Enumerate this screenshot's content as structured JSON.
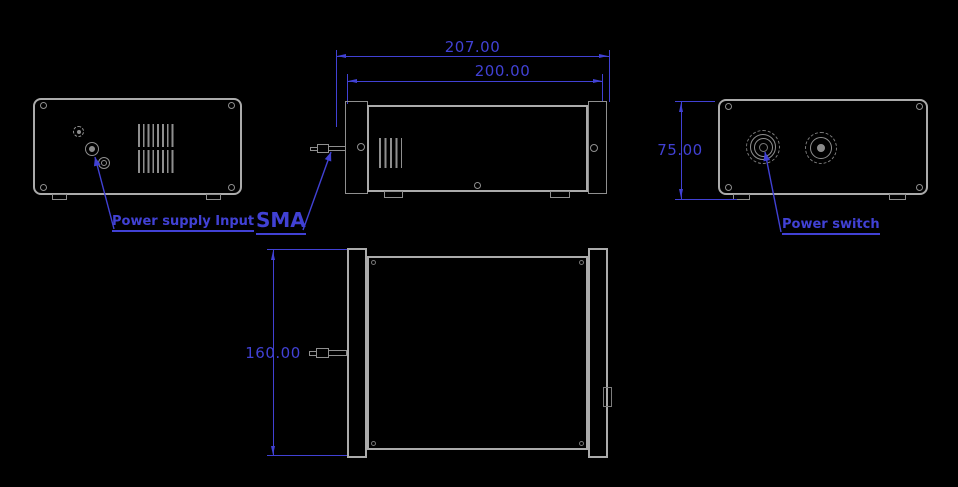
{
  "drawing": {
    "colors": {
      "accent": "#4141d4",
      "line": "#ababab"
    },
    "dims": {
      "overall_width": "207.00",
      "inner_width": "200.00",
      "panel_height": "75.00",
      "depth": "160.00"
    },
    "labels": {
      "power_supply_input": "Power supply Input",
      "sma": "SMA",
      "power_switch": "Power switch"
    }
  }
}
